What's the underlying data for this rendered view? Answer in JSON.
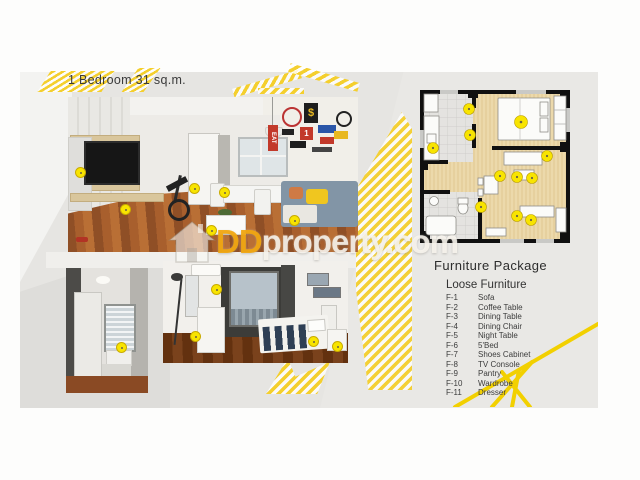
{
  "unit": {
    "title": "1 Bedroom 31 sq.m."
  },
  "watermark": {
    "brand_prefix": "DD",
    "brand_suffix": "property.com",
    "icon": "house-icon"
  },
  "furniture_package": {
    "heading": "Furniture Package",
    "subheading": "Loose Furniture",
    "items": [
      {
        "code": "F-1",
        "name": "Sofa"
      },
      {
        "code": "F-2",
        "name": "Coffee Table"
      },
      {
        "code": "F-3",
        "name": "Dining Table"
      },
      {
        "code": "F-4",
        "name": "Dining Chair"
      },
      {
        "code": "F-5",
        "name": "Night Table"
      },
      {
        "code": "F-6",
        "name": "5'Bed"
      },
      {
        "code": "F-7",
        "name": "Shoes Cabinet"
      },
      {
        "code": "F-8",
        "name": "TV Console"
      },
      {
        "code": "F-9",
        "name": "Pantry"
      },
      {
        "code": "F-10",
        "name": "Wardrobe"
      },
      {
        "code": "F-11",
        "name": "Dresser"
      }
    ]
  },
  "photos": {
    "living_room": {
      "wall_decals": {
        "eat": "EAT",
        "dollar": "$",
        "one": "1"
      }
    }
  },
  "colors": {
    "accent_yellow": "#f4cf2e",
    "marker_yellow": "#f8e400",
    "slide_gray": "#e6e5e2",
    "plan_wood": "#ecd9ab",
    "watermark_orange": "#f2a60d"
  }
}
